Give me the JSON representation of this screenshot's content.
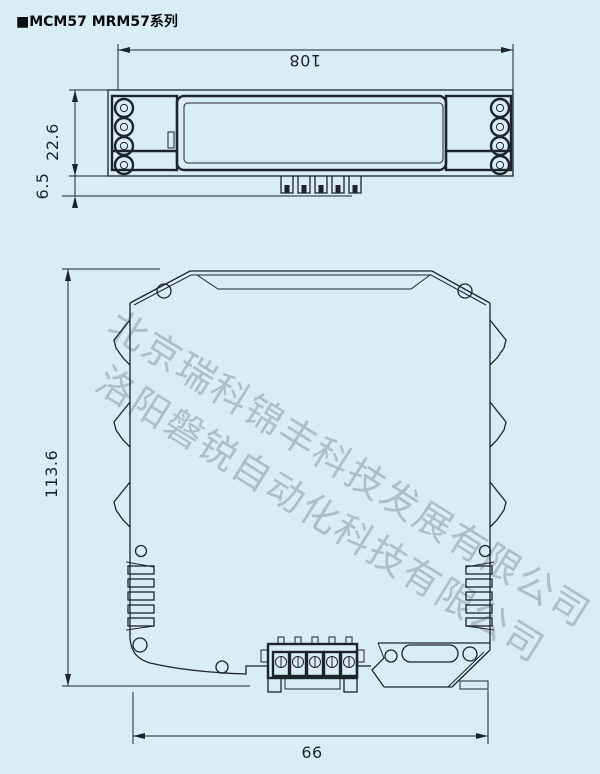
{
  "title": "■MCM57 MRM57系列",
  "watermarks": {
    "line1": "北京瑞科锦丰科技发展有限公司",
    "line2": "洛阳磐锐自动化科技有限公司"
  },
  "dimensions": {
    "top_width": "108",
    "top_height": "22.6",
    "pin_height": "6.5",
    "front_height": "113.6",
    "front_width": "66"
  },
  "colors": {
    "background": "#d9edf7",
    "line": "#1d242b",
    "watermark": "#6c7b8a"
  }
}
